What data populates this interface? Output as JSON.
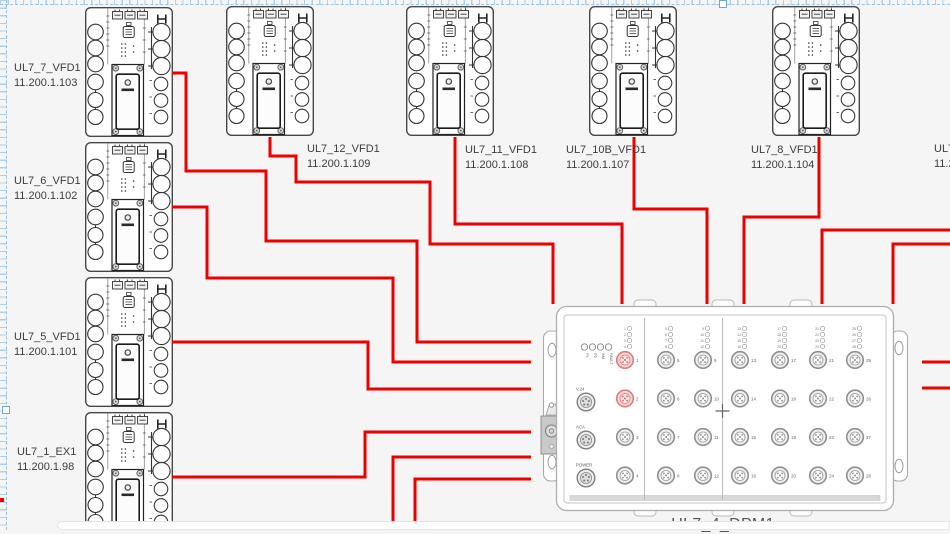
{
  "colors": {
    "cable": "#ee0000",
    "canvas_bg": "#f5f5f5",
    "guide": "#9dc3e3",
    "device_stroke": "#474747",
    "dpm_stroke": "#ababab",
    "red_port_fill": "#f7d4d4",
    "red_port_stroke": "#d98080"
  },
  "devices": [
    {
      "name": "UL7_7_VFD1",
      "ip": "11.200.1.103"
    },
    {
      "name": "UL7_6_VFD1",
      "ip": "11.200.1.102"
    },
    {
      "name": "UL7_5_VFD1",
      "ip": "11.200.1.101"
    },
    {
      "name": "UL7_1_EX1",
      "ip": "11.200.1.98"
    },
    {
      "name": "UL7_12_VFD1",
      "ip": "11.200.1.109"
    },
    {
      "name": "UL7_11_VFD1",
      "ip": "11.200.1.108"
    },
    {
      "name": "UL7_10B_VFD1",
      "ip": "11.200.1.107"
    },
    {
      "name": "UL7_8_VFD1",
      "ip": "11.200.1.104"
    },
    {
      "name": "UL7",
      "ip": "11.2"
    }
  ],
  "dpm": {
    "name": "UL7_4_DPM1",
    "status_leds": [
      "P1",
      "P2",
      "RM",
      "FAULT"
    ],
    "side_connectors": [
      "V.24",
      "ACA",
      "POWER"
    ],
    "port_columns": [
      [
        1,
        2,
        3,
        4
      ],
      [
        5,
        6,
        7,
        8
      ],
      [
        9,
        10,
        11,
        12
      ],
      [
        13,
        14,
        15,
        16
      ],
      [
        17,
        18,
        19,
        20
      ],
      [
        21,
        22,
        23,
        24
      ],
      [
        25,
        26,
        27,
        28
      ]
    ],
    "red_ports": [
      1,
      2
    ]
  },
  "cables": [
    [
      [
        172,
        73
      ],
      [
        186,
        73
      ],
      [
        186,
        171
      ],
      [
        266,
        171
      ],
      [
        266,
        241
      ],
      [
        417,
        241
      ],
      [
        417,
        342
      ],
      [
        531,
        342
      ]
    ],
    [
      [
        172,
        207
      ],
      [
        207,
        207
      ],
      [
        207,
        278
      ],
      [
        393,
        278
      ],
      [
        393,
        362
      ],
      [
        531,
        362
      ]
    ],
    [
      [
        172,
        342
      ],
      [
        368,
        342
      ],
      [
        368,
        389
      ],
      [
        531,
        389
      ]
    ],
    [
      [
        172,
        477
      ],
      [
        365,
        477
      ],
      [
        365,
        432
      ],
      [
        531,
        432
      ]
    ],
    [
      [
        270,
        137
      ],
      [
        270,
        156
      ],
      [
        296,
        156
      ],
      [
        296,
        182
      ],
      [
        430,
        182
      ],
      [
        430,
        244
      ],
      [
        553,
        244
      ],
      [
        553,
        304
      ]
    ],
    [
      [
        455,
        137
      ],
      [
        455,
        224
      ],
      [
        622,
        224
      ],
      [
        622,
        304
      ]
    ],
    [
      [
        634,
        137
      ],
      [
        634,
        209
      ],
      [
        707,
        209
      ],
      [
        707,
        304
      ]
    ],
    [
      [
        819,
        137
      ],
      [
        819,
        217
      ],
      [
        744,
        217
      ],
      [
        744,
        304
      ]
    ],
    [
      [
        950,
        230
      ],
      [
        822,
        230
      ],
      [
        822,
        304
      ]
    ],
    [
      [
        950,
        244
      ],
      [
        893,
        244
      ],
      [
        893,
        304
      ]
    ],
    [
      [
        393,
        531
      ],
      [
        393,
        457
      ],
      [
        531,
        457
      ]
    ],
    [
      [
        415,
        531
      ],
      [
        415,
        479
      ],
      [
        531,
        479
      ]
    ],
    [
      [
        922,
        362
      ],
      [
        950,
        362
      ]
    ],
    [
      [
        922,
        388
      ],
      [
        950,
        388
      ]
    ]
  ]
}
